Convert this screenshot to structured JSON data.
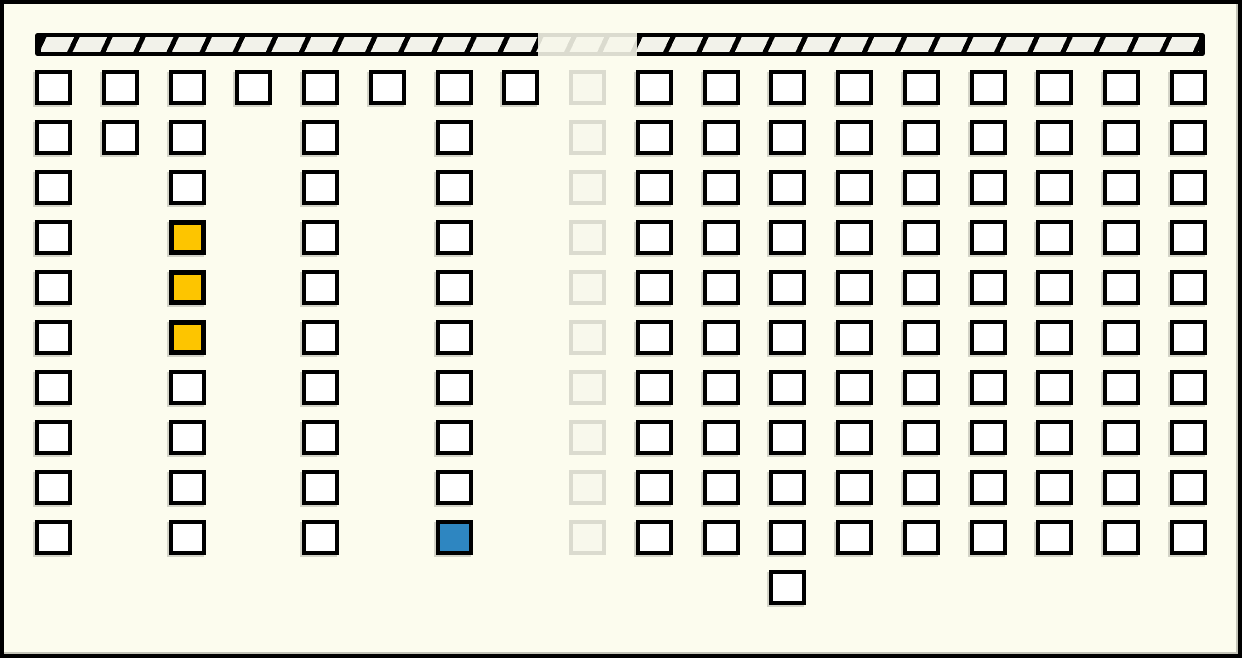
{
  "canvas": {
    "width": 1242,
    "height": 658
  },
  "colors": {
    "background": "#FCFCEE",
    "frame_border": "#000000",
    "cell_fill": "#FFFFFF",
    "cell_border": "#000000",
    "highlight_yellow": "#FDC500",
    "highlight_blue": "#2E86C1",
    "faded_stroke": "#DBDBCF",
    "faded_fill": "#F8F8EC",
    "wall_hatch_fill": "#F2F2EA",
    "wall_hatch_line": "#000000"
  },
  "wall": {
    "y": 33,
    "height": 23,
    "segments": [
      {
        "state": "normal",
        "x": 35,
        "width": 503
      },
      {
        "state": "faded",
        "x": 538,
        "width": 99
      },
      {
        "state": "normal",
        "x": 637,
        "width": 568
      }
    ]
  },
  "grid": {
    "origin_x": 35,
    "origin_y": 70,
    "col_step": 66.76,
    "row_step": 50,
    "cell_width": 37,
    "cell_height": 35,
    "num_columns": 18,
    "num_rows": 10,
    "columns": [
      {
        "col": 0,
        "rows": [
          0,
          1,
          2,
          3,
          4,
          5,
          6,
          7,
          8,
          9
        ],
        "state": "normal",
        "highlights": {}
      },
      {
        "col": 1,
        "rows": [
          0,
          1
        ],
        "state": "normal",
        "highlights": {}
      },
      {
        "col": 2,
        "rows": [
          0,
          1,
          2,
          3,
          4,
          5,
          6,
          7,
          8,
          9
        ],
        "state": "normal",
        "highlights": {
          "3": "yellow",
          "4": "yellow",
          "5": "yellow"
        }
      },
      {
        "col": 3,
        "rows": [
          0
        ],
        "state": "normal",
        "highlights": {}
      },
      {
        "col": 4,
        "rows": [
          0,
          1,
          2,
          3,
          4,
          5,
          6,
          7,
          8,
          9
        ],
        "state": "normal",
        "highlights": {}
      },
      {
        "col": 5,
        "rows": [
          0
        ],
        "state": "normal",
        "highlights": {}
      },
      {
        "col": 6,
        "rows": [
          0,
          1,
          2,
          3,
          4,
          5,
          6,
          7,
          8,
          9
        ],
        "state": "normal",
        "highlights": {
          "9": "blue"
        }
      },
      {
        "col": 7,
        "rows": [
          0
        ],
        "state": "normal",
        "highlights": {}
      },
      {
        "col": 8,
        "rows": [
          0,
          1,
          2,
          3,
          4,
          5,
          6,
          7,
          8,
          9
        ],
        "state": "faded",
        "highlights": {}
      },
      {
        "col": 9,
        "rows": [
          0,
          1,
          2,
          3,
          4,
          5,
          6,
          7,
          8,
          9
        ],
        "state": "normal",
        "highlights": {}
      },
      {
        "col": 10,
        "rows": [
          0,
          1,
          2,
          3,
          4,
          5,
          6,
          7,
          8,
          9
        ],
        "state": "normal",
        "highlights": {}
      },
      {
        "col": 11,
        "rows": [
          0,
          1,
          2,
          3,
          4,
          5,
          6,
          7,
          8,
          9,
          10
        ],
        "state": "normal",
        "highlights": {}
      },
      {
        "col": 12,
        "rows": [
          0,
          1,
          2,
          3,
          4,
          5,
          6,
          7,
          8,
          9
        ],
        "state": "normal",
        "highlights": {}
      },
      {
        "col": 13,
        "rows": [
          0,
          1,
          2,
          3,
          4,
          5,
          6,
          7,
          8,
          9
        ],
        "state": "normal",
        "highlights": {}
      },
      {
        "col": 14,
        "rows": [
          0,
          1,
          2,
          3,
          4,
          5,
          6,
          7,
          8,
          9
        ],
        "state": "normal",
        "highlights": {}
      },
      {
        "col": 15,
        "rows": [
          0,
          1,
          2,
          3,
          4,
          5,
          6,
          7,
          8,
          9
        ],
        "state": "normal",
        "highlights": {}
      },
      {
        "col": 16,
        "rows": [
          0,
          1,
          2,
          3,
          4,
          5,
          6,
          7,
          8,
          9
        ],
        "state": "normal",
        "highlights": {}
      },
      {
        "col": 17,
        "rows": [
          0,
          1,
          2,
          3,
          4,
          5,
          6,
          7,
          8,
          9
        ],
        "state": "normal",
        "highlights": {}
      }
    ]
  }
}
